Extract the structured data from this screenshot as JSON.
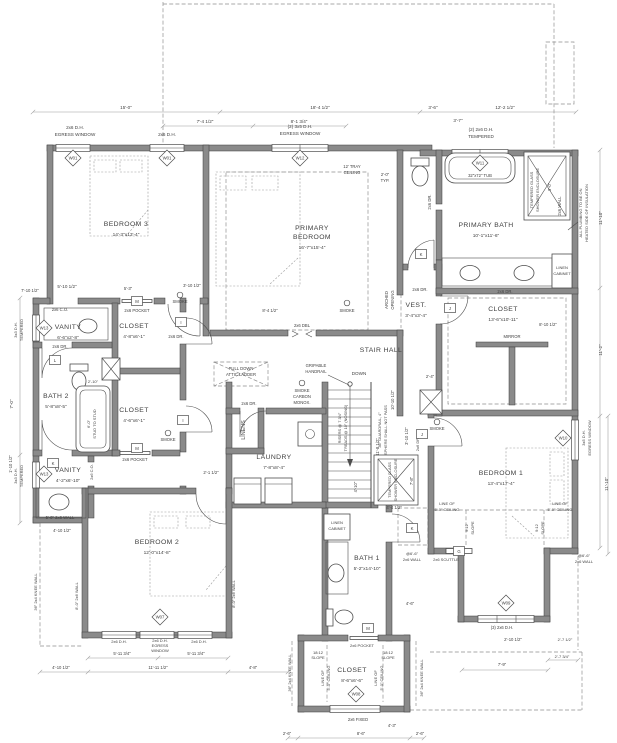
{
  "drawing": {
    "type": "second floor plan",
    "colors": {
      "wall_fill": "#8a8a8a",
      "wall_stroke": "#3a3a3a",
      "line": "#4d4d4d",
      "dim": "#9a9a9a"
    },
    "rooms": [
      {
        "lines": [
          "BEDROOM 3"
        ],
        "size": "14'-3\"x13'-4\"",
        "x": 126,
        "y": 226
      },
      {
        "lines": [
          "PRIMARY",
          "BEDROOM"
        ],
        "size": "16'-7\"x15'-4\"",
        "x": 312,
        "y": 230
      },
      {
        "lines": [
          "PRIMARY BATH"
        ],
        "size": "10'-1\"x11'-6\"",
        "x": 486,
        "y": 227
      },
      {
        "lines": [
          "VEST."
        ],
        "size": "3'-4\"x3'-4\"",
        "x": 416,
        "y": 307
      },
      {
        "lines": [
          "CLOSET"
        ],
        "size": "13'-6\"x10'-11\"",
        "x": 503,
        "y": 311
      },
      {
        "lines": [
          "STAIR HALL"
        ],
        "size": "",
        "x": 381,
        "y": 352
      },
      {
        "lines": [
          "VANITY"
        ],
        "size": "6'-6\"x2'-8\"",
        "x": 68,
        "y": 329
      },
      {
        "lines": [
          "CLOSET"
        ],
        "size": "4'-8\"x6'-1\"",
        "x": 134,
        "y": 328
      },
      {
        "lines": [
          "BATH 2"
        ],
        "size": "5'-8\"x8'-5\"",
        "x": 56,
        "y": 398
      },
      {
        "lines": [
          "CLOSET"
        ],
        "size": "4'-6\"x6'-1\"",
        "x": 134,
        "y": 412
      },
      {
        "lines": [
          "VANITY"
        ],
        "size": "4'-2\"x6'-10\"",
        "x": 68,
        "y": 472
      },
      {
        "lines": [
          "LAUNDRY"
        ],
        "size": "7'-8\"x8'-4\"",
        "x": 274,
        "y": 459
      },
      {
        "lines": [
          "BEDROOM 2"
        ],
        "size": "12'-0\"x14'-8\"",
        "x": 157,
        "y": 544
      },
      {
        "lines": [
          "BATH 1"
        ],
        "size": "5'-2\"x14'-10\"",
        "x": 367,
        "y": 560
      },
      {
        "lines": [
          "CLOSET"
        ],
        "size": "8'-6\"x6'-6\"",
        "x": 352,
        "y": 672
      },
      {
        "lines": [
          "BEDROOM 1"
        ],
        "size": "13'-4\"x17'-4\"",
        "x": 501,
        "y": 475
      }
    ],
    "window_tags": [
      [
        "W01",
        73,
        158
      ],
      [
        "W01",
        167,
        158
      ],
      [
        "W12",
        300,
        158
      ],
      [
        "W11",
        480,
        163
      ],
      [
        "W13",
        44,
        328
      ],
      [
        "W13",
        44,
        474
      ],
      [
        "W07",
        160,
        617
      ],
      [
        "W08",
        356,
        694
      ],
      [
        "W09",
        506,
        603
      ],
      [
        "W10",
        563,
        438
      ]
    ],
    "door_tags": [
      [
        "M",
        137,
        301
      ],
      [
        "I",
        181,
        322
      ],
      [
        "L",
        55,
        360
      ],
      [
        "M",
        137,
        448
      ],
      [
        "I",
        183,
        420
      ],
      [
        "K",
        53,
        463
      ],
      [
        "K",
        421,
        254
      ],
      [
        "J",
        450,
        308
      ],
      [
        "J",
        422,
        434
      ],
      [
        "K",
        412,
        528
      ],
      [
        "G",
        459,
        551
      ],
      [
        "M",
        368,
        628
      ]
    ],
    "detectors": [
      [
        180,
        295
      ],
      [
        347,
        303
      ],
      [
        437,
        422
      ],
      [
        168,
        433
      ],
      [
        302,
        383
      ]
    ],
    "notes": [
      [
        "15'-0\"",
        126,
        109
      ],
      [
        "18'-4 1/2\"",
        320,
        109
      ],
      [
        "3'-6\"",
        433,
        109
      ],
      [
        "12'-2 1/2\"",
        505,
        109
      ],
      [
        "7'-4 1/2\"",
        205,
        123
      ],
      [
        "8'-1 3/4\"",
        299,
        123
      ],
      [
        "3'-7\"",
        458,
        122
      ],
      [
        "2x6 D.H.",
        75,
        129
      ],
      [
        "EGRESS WINDOW",
        75,
        136
      ],
      [
        "2x6 D.H.",
        167,
        136
      ],
      [
        "(2) 3x5 D.H.",
        300,
        128
      ],
      [
        "EGRESS WINDOW",
        300,
        135
      ],
      [
        "(2) 2x6 D.H.",
        481,
        131
      ],
      [
        "TEMPERED",
        481,
        138
      ],
      [
        "5'-10 1/2\"",
        67,
        288
      ],
      [
        "7'-10 1/2\"",
        30,
        292,
        0,
        4.2
      ],
      [
        "3x3 D.H.",
        17,
        330,
        -90,
        4
      ],
      [
        "TEMPERED",
        23,
        330,
        -90,
        4
      ],
      [
        "3x3 D.H.",
        17,
        476,
        -90,
        4
      ],
      [
        "TEMPERED",
        23,
        476,
        -90,
        4
      ],
      [
        "7'-0\"",
        13,
        404,
        -90
      ],
      [
        "1'-10 1/2\"",
        12,
        464,
        -90,
        4.2
      ],
      [
        "11'-10\"",
        602,
        218,
        -90
      ],
      [
        "11'-2\"",
        602,
        350,
        -90
      ],
      [
        "11'-10\"",
        608,
        484,
        -90
      ],
      [
        "2x6 WALL",
        561,
        206,
        -90,
        4.2
      ],
      [
        "ALL PLUMBING TO BE ON",
        582,
        213,
        -90,
        4
      ],
      [
        "HEATED SIDE OF INSULATION",
        588,
        213,
        -90,
        4
      ],
      [
        "3x5 D.H.",
        585,
        438,
        -90,
        4
      ],
      [
        "EGRESS WINDOW",
        591,
        438,
        -90,
        4
      ],
      [
        "12' TRAY",
        352,
        168,
        0,
        4.2
      ],
      [
        "CEILING",
        352,
        174,
        0,
        4.2
      ],
      [
        "2'-0\"",
        385,
        176,
        0,
        4.2
      ],
      [
        "TYP.",
        385,
        182,
        0,
        4.2
      ],
      [
        "32\"x72\" TUB",
        480,
        177,
        0,
        4.2
      ],
      [
        "TEMPERED GLASS",
        533,
        190,
        -90,
        4
      ],
      [
        "SHOWER ENCLOSURE",
        539,
        190,
        -90,
        4
      ],
      [
        "3'-0\"",
        551,
        187,
        -90,
        4.2
      ],
      [
        "2x6 DR.",
        431,
        202,
        -90,
        4.2
      ],
      [
        "LINEN",
        562,
        269,
        0,
        4
      ],
      [
        "CABINET",
        562,
        275,
        0,
        4
      ],
      [
        "ARCHED",
        388,
        300,
        -90,
        4.2
      ],
      [
        "OPENING",
        394,
        300,
        -90,
        4.2
      ],
      [
        "MIRROR",
        512,
        338,
        0,
        4.2
      ],
      [
        "2x6 DR.",
        420,
        291,
        0,
        4.2
      ],
      [
        "2x6 DR.",
        505,
        293,
        0,
        4.2
      ],
      [
        "2'-4\"",
        430,
        378,
        0,
        4.2
      ],
      [
        "8'-10 1/2\"",
        548,
        326,
        0,
        4.2
      ],
      [
        "2x6 DBL",
        302,
        327,
        0,
        4.2
      ],
      [
        "GRIPABLE",
        316,
        367,
        0,
        4.2
      ],
      [
        "HANDRAIL",
        316,
        373,
        0,
        4.2
      ],
      [
        "DOWN",
        359,
        375
      ],
      [
        "SMOKE",
        302,
        392,
        0,
        4.2
      ],
      [
        "CARBON",
        302,
        398,
        0,
        4.2
      ],
      [
        "MONOX.",
        302,
        404,
        0,
        4.2
      ],
      [
        "PULL DOWN",
        241,
        370,
        0,
        4.2
      ],
      [
        "ATTIC LADDER",
        241,
        376,
        0,
        4.2
      ],
      [
        "36\" GUARDRAIL, 4\"",
        381,
        430,
        -90,
        3.9
      ],
      [
        "SPHERE SHALL NOT PASS",
        387,
        430,
        -90,
        3.9
      ],
      [
        "RISERS @ 7 3/4\"",
        341,
        428,
        -90,
        3.9
      ],
      [
        "TREADS @ 10\" (NOSING)",
        347,
        428,
        -90,
        3.9
      ],
      [
        "10'-10 1/2\"",
        394,
        400,
        -90,
        4.2
      ],
      [
        "11'-8 1/2\"",
        379,
        447,
        -90,
        4.2
      ],
      [
        "4'-10\"",
        357,
        487,
        -90,
        4.2
      ],
      [
        "3'-10 1/2\"",
        408,
        436,
        -90,
        4.2
      ],
      [
        "7'-8\"",
        413,
        481,
        -90,
        4.2
      ],
      [
        "4'-4 1/2\"",
        394,
        509,
        0,
        4.2
      ],
      [
        "TEMPERED GLASS",
        391,
        480,
        -90,
        3.9
      ],
      [
        "SHOWER ENCLOSURE",
        397,
        480,
        -90,
        3.9
      ],
      [
        "2x6 C.O.",
        60,
        311,
        0,
        4.2
      ],
      [
        "2x6 POCKET",
        137,
        312,
        0,
        4.2
      ],
      [
        "3'-10 1/2\"",
        192,
        287,
        0,
        4.2
      ],
      [
        "5'-3\"",
        128,
        290,
        0,
        4.2
      ],
      [
        "8'-4 1/2\"",
        270,
        312,
        0,
        4.2
      ],
      [
        "SMOKE",
        180,
        303,
        0,
        4.2
      ],
      [
        "SMOKE",
        347,
        312,
        0,
        4.2
      ],
      [
        "SMOKE",
        437,
        430,
        0,
        4.2
      ],
      [
        "SMOKE",
        168,
        441,
        0,
        4.2
      ],
      [
        "2x6 DR.",
        60,
        348,
        0,
        4.2
      ],
      [
        "2x6 DR.",
        176,
        338,
        0,
        4.2
      ],
      [
        "2'-10\"",
        93,
        383,
        0,
        4
      ],
      [
        "6'-0\"",
        90,
        424,
        -90,
        4
      ],
      [
        "STUD TO STUD",
        96,
        424,
        -90,
        4
      ],
      [
        "2x6 POCKET",
        135,
        461,
        0,
        4.2
      ],
      [
        "2x6 C.O.",
        93,
        472,
        -90,
        4
      ],
      [
        "2x6 DR.",
        249,
        405,
        0,
        4.2
      ],
      [
        "2'-1 1/2\"",
        211,
        474,
        0,
        4.2
      ],
      [
        "LINENS",
        245,
        430,
        -90,
        5.4
      ],
      [
        "5'-0\" 2x6 WALL",
        60,
        519,
        0,
        4.2
      ],
      [
        "4'-10 1/2\"",
        62,
        532,
        0,
        4.2
      ],
      [
        "36\" 2x4 KNEE WALL",
        37,
        592,
        -90,
        4
      ],
      [
        "8'-0\" 2x6 WALL",
        78,
        596,
        -90,
        4
      ],
      [
        "8'-0\" 2x6 WALL",
        235,
        594,
        -90,
        4
      ],
      [
        "2x6 D.H.",
        119,
        643,
        0,
        4
      ],
      [
        "2x6 D.H.",
        199,
        643,
        0,
        4
      ],
      [
        "2x6 D.H.",
        160,
        642,
        0,
        4
      ],
      [
        "EGRESS",
        160,
        647,
        0,
        4
      ],
      [
        "WINDOW",
        160,
        652,
        0,
        4
      ],
      [
        "5'-11 3/4\"",
        122,
        655,
        0,
        4.2
      ],
      [
        "5'-11 3/4\"",
        196,
        655,
        0,
        4.2
      ],
      [
        "4'-10 1/2\"",
        61,
        669,
        0,
        4.2
      ],
      [
        "11'-11 1/2\"",
        158,
        669,
        0,
        4.2
      ],
      [
        "4'-8\"",
        253,
        669,
        0,
        4.2
      ],
      [
        "2'-6\"",
        287,
        735,
        0,
        4.2
      ],
      [
        "8'-6\"",
        361,
        735,
        0,
        4.2
      ],
      [
        "2'-6\"",
        420,
        735,
        0,
        4.2
      ],
      [
        "4'-3\"",
        392,
        727,
        0,
        4.2
      ],
      [
        "2x6 FIXED",
        358,
        721,
        0,
        4.2
      ],
      [
        "2x6 POCKET",
        362,
        647,
        0,
        4
      ],
      [
        "18:12",
        318,
        654,
        0,
        4
      ],
      [
        "SLOPE",
        318,
        659,
        0,
        4
      ],
      [
        "18:12",
        388,
        654,
        0,
        4
      ],
      [
        "SLOPE",
        388,
        659,
        0,
        4
      ],
      [
        "LINE OF",
        324,
        678,
        -90,
        4
      ],
      [
        "5'-0\" CEILING",
        330,
        678,
        -90,
        4
      ],
      [
        "LINE OF",
        377,
        678,
        -90,
        4
      ],
      [
        "5'-0\" CEILING",
        383,
        678,
        -90,
        4
      ],
      [
        "36\" 2x4 KNEE WALL",
        291,
        673,
        -90,
        4
      ],
      [
        "36\" 2x4 KNEE WALL",
        423,
        678,
        -90,
        4
      ],
      [
        "LINEN",
        337,
        524,
        0,
        4
      ],
      [
        "CABINET",
        337,
        530,
        0,
        4
      ],
      [
        "4'-6\"",
        410,
        605,
        0,
        4.2
      ],
      [
        "LINE OF",
        447,
        505,
        0,
        4
      ],
      [
        "5'-0\" CEILING",
        447,
        511,
        0,
        4
      ],
      [
        "LINE OF",
        560,
        505,
        0,
        4
      ],
      [
        "5'-0\" CEILING",
        560,
        511,
        0,
        4
      ],
      [
        "9:12",
        468,
        528,
        -90,
        4
      ],
      [
        "SLOPE",
        474,
        528,
        -90,
        4
      ],
      [
        "9:12",
        538,
        528,
        -90,
        4
      ],
      [
        "SLOPE",
        544,
        528,
        -90,
        4
      ],
      [
        "(3) 2x6 D.H.",
        502,
        629,
        0,
        4.2
      ],
      [
        "2'-10 1/2\"",
        513,
        641,
        0,
        4.2
      ],
      [
        "7'-9\"",
        502,
        666,
        0,
        4.2
      ],
      [
        "2'-7 1/2\"",
        565,
        641,
        0,
        4
      ],
      [
        "2'-7 3/4\"",
        562,
        658,
        0,
        4
      ],
      [
        "2x6 SCUTTLE",
        446,
        561,
        0,
        4
      ],
      [
        "@6'-6\"",
        412,
        555,
        0,
        4
      ],
      [
        "2x6 WALL",
        412,
        561,
        0,
        4
      ],
      [
        "@6'-6\"",
        584,
        557,
        0,
        4
      ],
      [
        "2x6 WALL",
        584,
        563,
        0,
        4
      ],
      [
        "2x6 DR.",
        419,
        444,
        -90,
        4
      ]
    ]
  }
}
